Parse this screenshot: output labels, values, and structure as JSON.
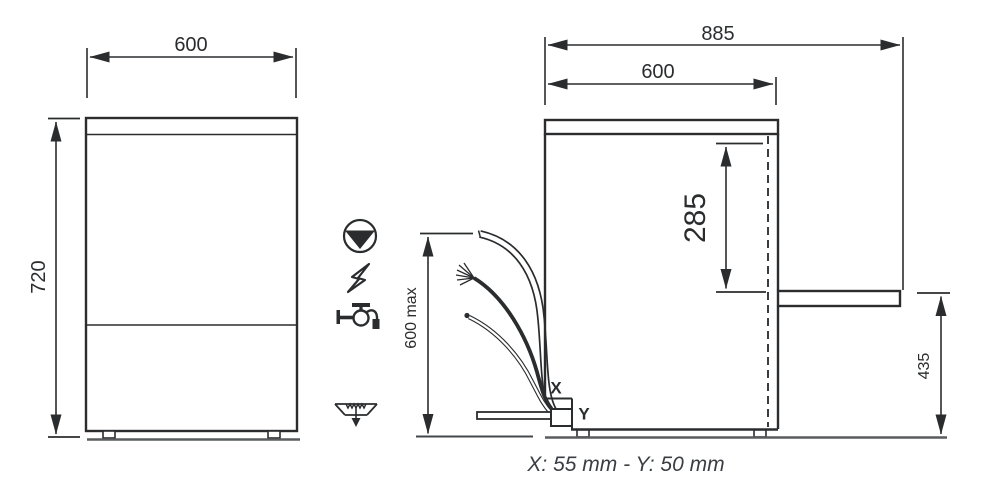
{
  "front_view": {
    "width": "600",
    "height": "720"
  },
  "side_view": {
    "depth_total": "885",
    "depth_body": "600",
    "door_top_offset": "285",
    "door_open_height": "435"
  },
  "connections": {
    "hose_max_height": "600 max",
    "x_label": "X",
    "y_label": "Y",
    "footnote": "X: 55 mm - Y: 50 mm"
  },
  "icons": {
    "icon1": "drain-pump",
    "icon2": "electrical-power",
    "icon3": "water-supply-tap",
    "icon4": "floor-drain"
  },
  "colors": {
    "line": "#2a2c2e",
    "ground": "#595d5f",
    "footnote_text": "#3a3e43"
  }
}
